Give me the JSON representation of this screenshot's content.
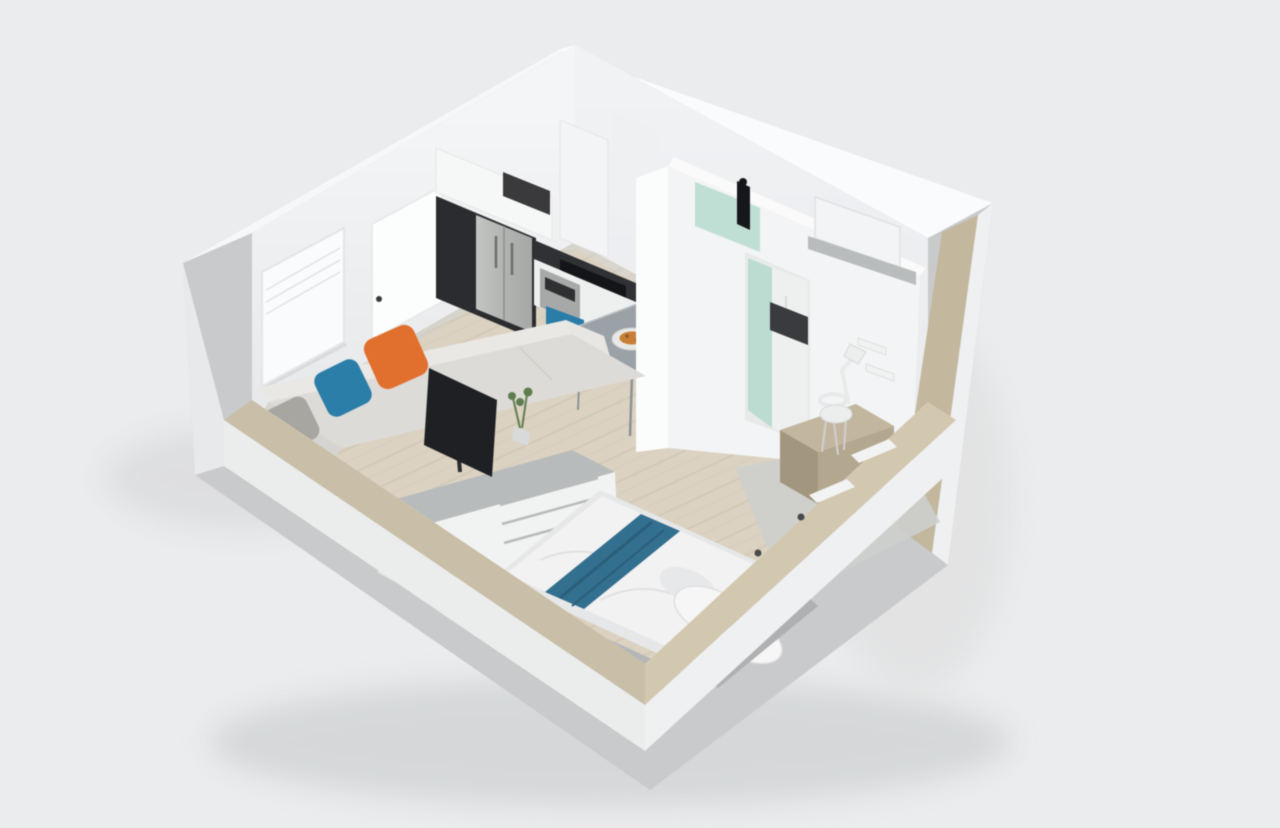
{
  "page": {
    "title": "3D Studio Apartment Floor Plan Render"
  },
  "scene": {
    "type": "isometric 3D dollhouse cutaway render of a studio apartment",
    "palette": {
      "bg": "#ebeced",
      "plinth": "#c8cacb",
      "outer_sw": "#ebecec",
      "outer_se": "#eff0f1",
      "outer_left": "#e8e9ea",
      "right_band": "#eef0f1",
      "tan_sw": "#c9bea7",
      "tan_se": "#d2c7af",
      "tan_tall": "#c3b79e",
      "top_band_nw": "#f6f7f8",
      "top_band_ne": "#fafbfc",
      "wall_nw_hi": "#f4f5f6",
      "wall_nw_lo": "#e6e8ea",
      "wall_ne_hi": "#f0f2f4",
      "wall_ne_lo": "#e8eaed",
      "inner_sw": "#f2f3f3",
      "inner_se": "#eef0f1",
      "floor_wood": "#dbd2c1",
      "plank": "#cdc4b2",
      "plank2": "#d5ccbb",
      "tile_gray": "#cdcfcd",
      "shadow": "#c5c7c8",
      "kitchen_dark": "#2b2c2f",
      "steel_hi": "#c3c5c3",
      "steel_lo": "#a6a8a6",
      "counter_dark": "#303135",
      "cooktop": "#141518",
      "cabinet_white": "#eef0f0",
      "oven_steel": "#a7a9a9",
      "upper_cab": "#f6f7f7",
      "niche_dark": "#3a3a3c",
      "pantry": "#f3f4f5",
      "pantry2": "#eff0f2",
      "sofa_back": "#e9e8e5",
      "sofa_seat": "#dddbd7",
      "sofa_chaise": "#d6d4d0",
      "pillow_gray": "#a7a6a1",
      "pillow_blue": "#2b7ea8",
      "pillow_orange": "#e1702e",
      "granite": "#b7bbbb",
      "desk_front": "#f1f2f2",
      "desk_side": "#e0e1e1",
      "tv": "#1f2023",
      "plant_green": "#5f7d4e",
      "pot": "#d8d9d9",
      "table_top": "#9aa1a7",
      "metal": "#8d9296",
      "chair_blue": "#2a7da7",
      "chair_orange": "#e0642a",
      "chair_orange_dk": "#c9571f",
      "plate": "#e8e8e6",
      "food": "#c67f35",
      "bath_face": "#f3f4f5",
      "bath_side": "#fbfcfc",
      "bath_trim": "#fafafa",
      "recess": "#e7eae9",
      "shower_glass": "#bcdcd2",
      "fixture": "#16171a",
      "mirror": "#f2f4f5",
      "sill": "#b9bcbd",
      "sink_dark": "#3a3b3f",
      "bed_base": "#e6e7e8",
      "duvet": "#f2f2f3",
      "runner": "#336f8e",
      "runner_dk": "#2a5f7b",
      "bpillow": "#f6f6f7",
      "bpillow_sh": "#e7e8ea",
      "throw": "#b5b6b7",
      "throw2": "#aeb0b1",
      "bolster": "#8d8f91",
      "bolster_hi": "#9ea0a1",
      "vanity_top": "#c2b69e",
      "vanity_front": "#b3a78f",
      "vanity_side": "#a2967e",
      "white_obj": "#eceded",
      "white_obj_line": "#d8d9da",
      "knob": "#4a4a4c",
      "handle": "#3a3a3a"
    },
    "rooms": [
      {
        "name": "kitchen",
        "position": "back-left",
        "items": [
          "refrigerator",
          "dark-tall-cabinet",
          "upper-cabinets",
          "microwave-niche",
          "dark-countertop",
          "cooktop",
          "oven",
          "pantry-columns",
          "faucet"
        ]
      },
      {
        "name": "bathroom",
        "position": "back-right",
        "items": [
          "glass-shower",
          "shower-fixture",
          "mirror",
          "vanity-sill",
          "sink-counter",
          "doorway"
        ]
      },
      {
        "name": "living-dining-area",
        "position": "center-left",
        "items": [
          "sofa-with-chaise",
          "gray-pillow",
          "blue-pillow",
          "orange-pillow",
          "media-desk",
          "tv",
          "plant",
          "dining-table",
          "blue-chair",
          "orange-chair",
          "plate-of-food"
        ]
      },
      {
        "name": "sleeping-area",
        "position": "front-right",
        "items": [
          "double-bed",
          "white-duvet",
          "blue-runner",
          "bed-pillows",
          "gray-throws",
          "headboard-bolster",
          "vanity-desk",
          "desk-chair",
          "desk-lamp",
          "wall-shelves",
          "gray-rug"
        ]
      }
    ],
    "architecture": {
      "left_wall": [
        "window-with-blinds",
        "door-with-handle"
      ],
      "walls": "white interior walls, tan-capped low front walls, gray plinth base",
      "floor": "light wood plank floor with gray tile patch"
    }
  }
}
